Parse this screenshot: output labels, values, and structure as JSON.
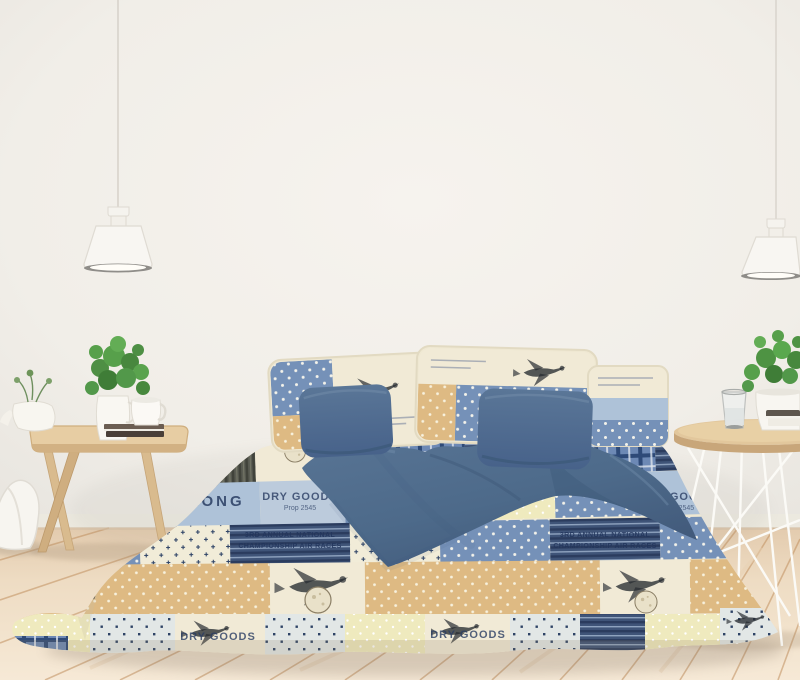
{
  "scene_label": "bedroom with patchwork bedding, two side tables, plants and pendant lamps",
  "bedding": {
    "patch_texts": {
      "annual_line1": "3RD ANNUAL NATIONAL",
      "annual_line2": "CHAMPIONSHIP AIR RACES",
      "long": "LONG",
      "dry_goods": "DRY GOODS",
      "prop": "Prop 2545"
    }
  },
  "palette": {
    "wall": "#f2efe9",
    "floor": "#eedcc3",
    "floor_seam": "#c1905f",
    "duvet_blue": "#4d6a8a",
    "patch_blue_dot": "#7591b8",
    "patch_tan": "#deba83",
    "patch_cream": "#f1ead6",
    "patch_pale_yellow": "#efeabe",
    "patch_navy": "#32476e",
    "wood_table": "#ddbf94",
    "plant_green": "#4e8f44",
    "lamp_white": "#f8f6f2"
  }
}
